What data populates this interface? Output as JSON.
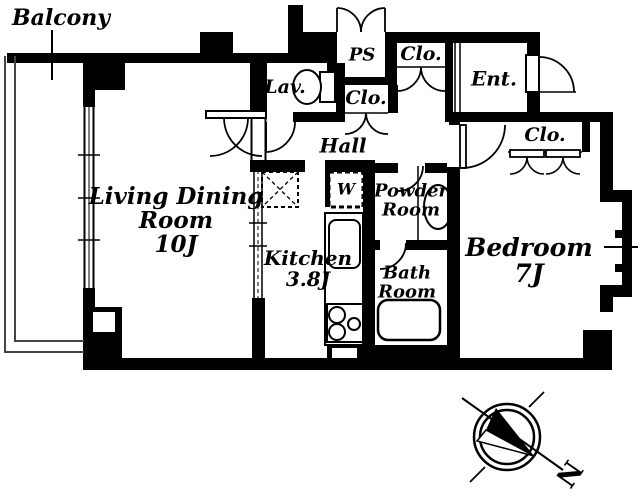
{
  "floor_plan": {
    "balcony": "Balcony",
    "living_dining": {
      "l1": "Living Dining",
      "l2": "Room",
      "l3": "10J"
    },
    "kitchen": {
      "l1": "Kitchen",
      "l2": "3.8J"
    },
    "lavatory": "Lav.",
    "pipe_space": "PS",
    "closet_top": "Clo.",
    "closet_hall": "Clo.",
    "closet_bedroom": "Clo.",
    "entrance": "Ent.",
    "hall": "Hall",
    "washer": "W",
    "powder_room": {
      "l1": "Powder",
      "l2": "Room"
    },
    "bath_room": {
      "l1": "Bath",
      "l2": "Room"
    },
    "bedroom": {
      "l1": "Bedroom",
      "l2": "7J"
    },
    "compass_north": "N"
  },
  "colors": {
    "wall": "#000000",
    "background": "#ffffff",
    "balcony_line": "#444444"
  }
}
